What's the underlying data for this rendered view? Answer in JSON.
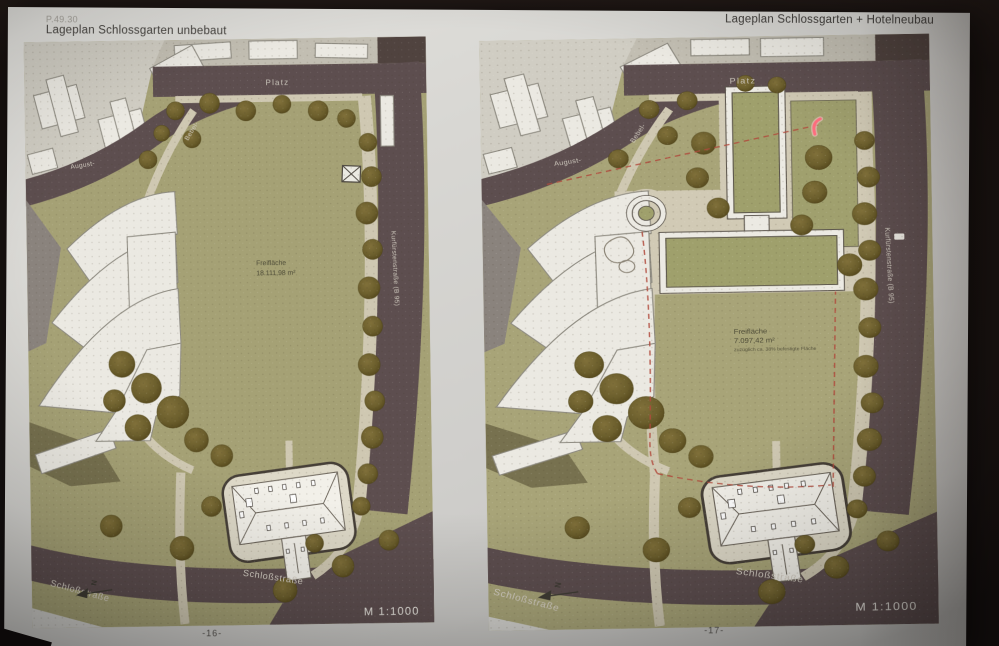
{
  "header": {
    "code": "P.49.30",
    "title_left": "Lageplan Schlossgarten unbebaut",
    "title_right": "Lageplan Schlossgarten + Hotelneubau"
  },
  "maps": {
    "left": {
      "platz": "Platz",
      "august_street": "August-",
      "bebel_street": "Bebel-",
      "side_street": "Kurfürstenstraße (B 95)",
      "area_label": "Freifläche",
      "area_value": "18.111,98 m²",
      "street_southwest": "Schloßstraße",
      "street_southeast": "Schloßstraße",
      "north_letter": "N",
      "scale": "M 1:1000",
      "page_number": "-16-"
    },
    "right": {
      "platz": "Platz",
      "august_street": "August-",
      "bebel_street": "Bebel-",
      "side_street": "Kurfürstenstraße (B 95)",
      "area_label": "Freifläche",
      "area_value": "7.097,42 m²",
      "area_note": "zuzüglich ca. 38% befestigte Fläche",
      "street_southwest": "Schloßstraße",
      "street_southeast": "Schloßstraße",
      "north_letter": "N",
      "scale": "M 1:1000",
      "page_number": "-17-"
    }
  },
  "colors": {
    "park_green": "#a5a175",
    "road": "#5d4e4f",
    "footpath": "#cfc8b2",
    "building": "#ebe9e2",
    "tree": "#6b5e2c",
    "boundary_red": "#b04a3c",
    "laser_mark": "#ff6d7e"
  }
}
